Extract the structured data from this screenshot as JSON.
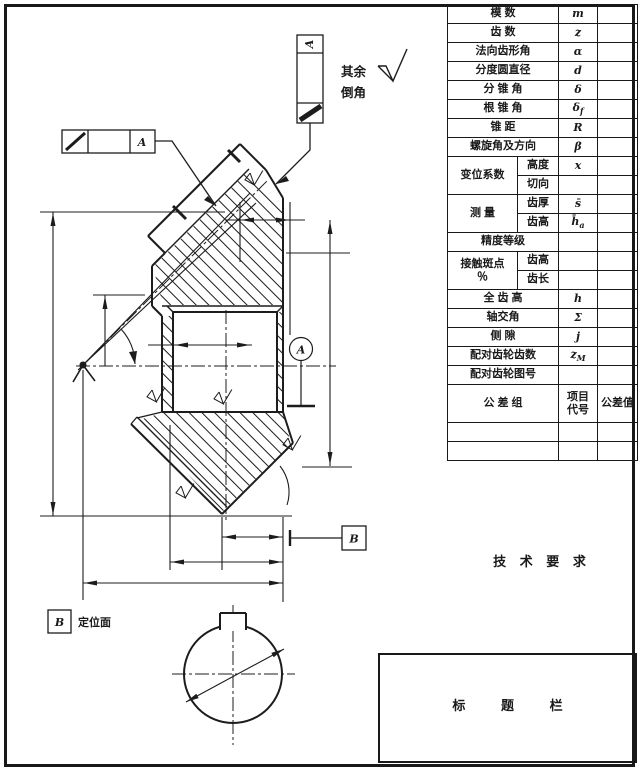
{
  "page": {
    "background": "#ffffff",
    "line_color": "#1a1a1a"
  },
  "drawing": {
    "top_tag_letter": "A",
    "fcf_datum_letter": "A",
    "datum_circle_letter": "A",
    "datum_b_letter": "B",
    "locating_frame_letter": "B",
    "locating_face_text": "定位面",
    "surface_note_line1": "其余",
    "surface_note_line2": "倒角"
  },
  "table": {
    "rows": [
      {
        "label": "模  数",
        "sym": "m"
      },
      {
        "label": "齿  数",
        "sym": "z"
      },
      {
        "label": "法向齿形角",
        "sym": "α"
      },
      {
        "label": "分度圆直径",
        "sym": "d"
      },
      {
        "label": "分 锥 角",
        "sym": "δ"
      },
      {
        "label": "根 锥 角",
        "sym": "δ",
        "symsub": "f"
      },
      {
        "label": "锥  距",
        "sym": "R"
      },
      {
        "label": "螺旋角及方向",
        "sym": "β"
      },
      {
        "label": "变位系数",
        "sub": "高度",
        "sym": "x"
      },
      {
        "sub": "切向",
        "sym": ""
      },
      {
        "label": "测  量",
        "sub": "齿厚",
        "sym": "s̄"
      },
      {
        "sub": "齿高",
        "sym": "h̄",
        "symsub": "a"
      },
      {
        "label": "精度等级",
        "sym": ""
      },
      {
        "label": "接触斑点",
        "label2": "％",
        "sub": "齿高",
        "sym": ""
      },
      {
        "sub": "齿长",
        "sym": ""
      },
      {
        "label": "全 齿 高",
        "sym": "h"
      },
      {
        "label": "轴交角",
        "sym": "Σ"
      },
      {
        "label": "侧  隙",
        "sym": "j"
      },
      {
        "label": "配对齿轮齿数",
        "sym": "z",
        "symsub": "M"
      },
      {
        "label": "配对齿轮图号",
        "sym": ""
      },
      {
        "label": "公 差 组",
        "sym_l1": "项目",
        "sym_l2": "代号",
        "val": "公差值"
      }
    ]
  },
  "tech_requirements": "技 术 要 求",
  "title_block_text": "标 题 栏"
}
